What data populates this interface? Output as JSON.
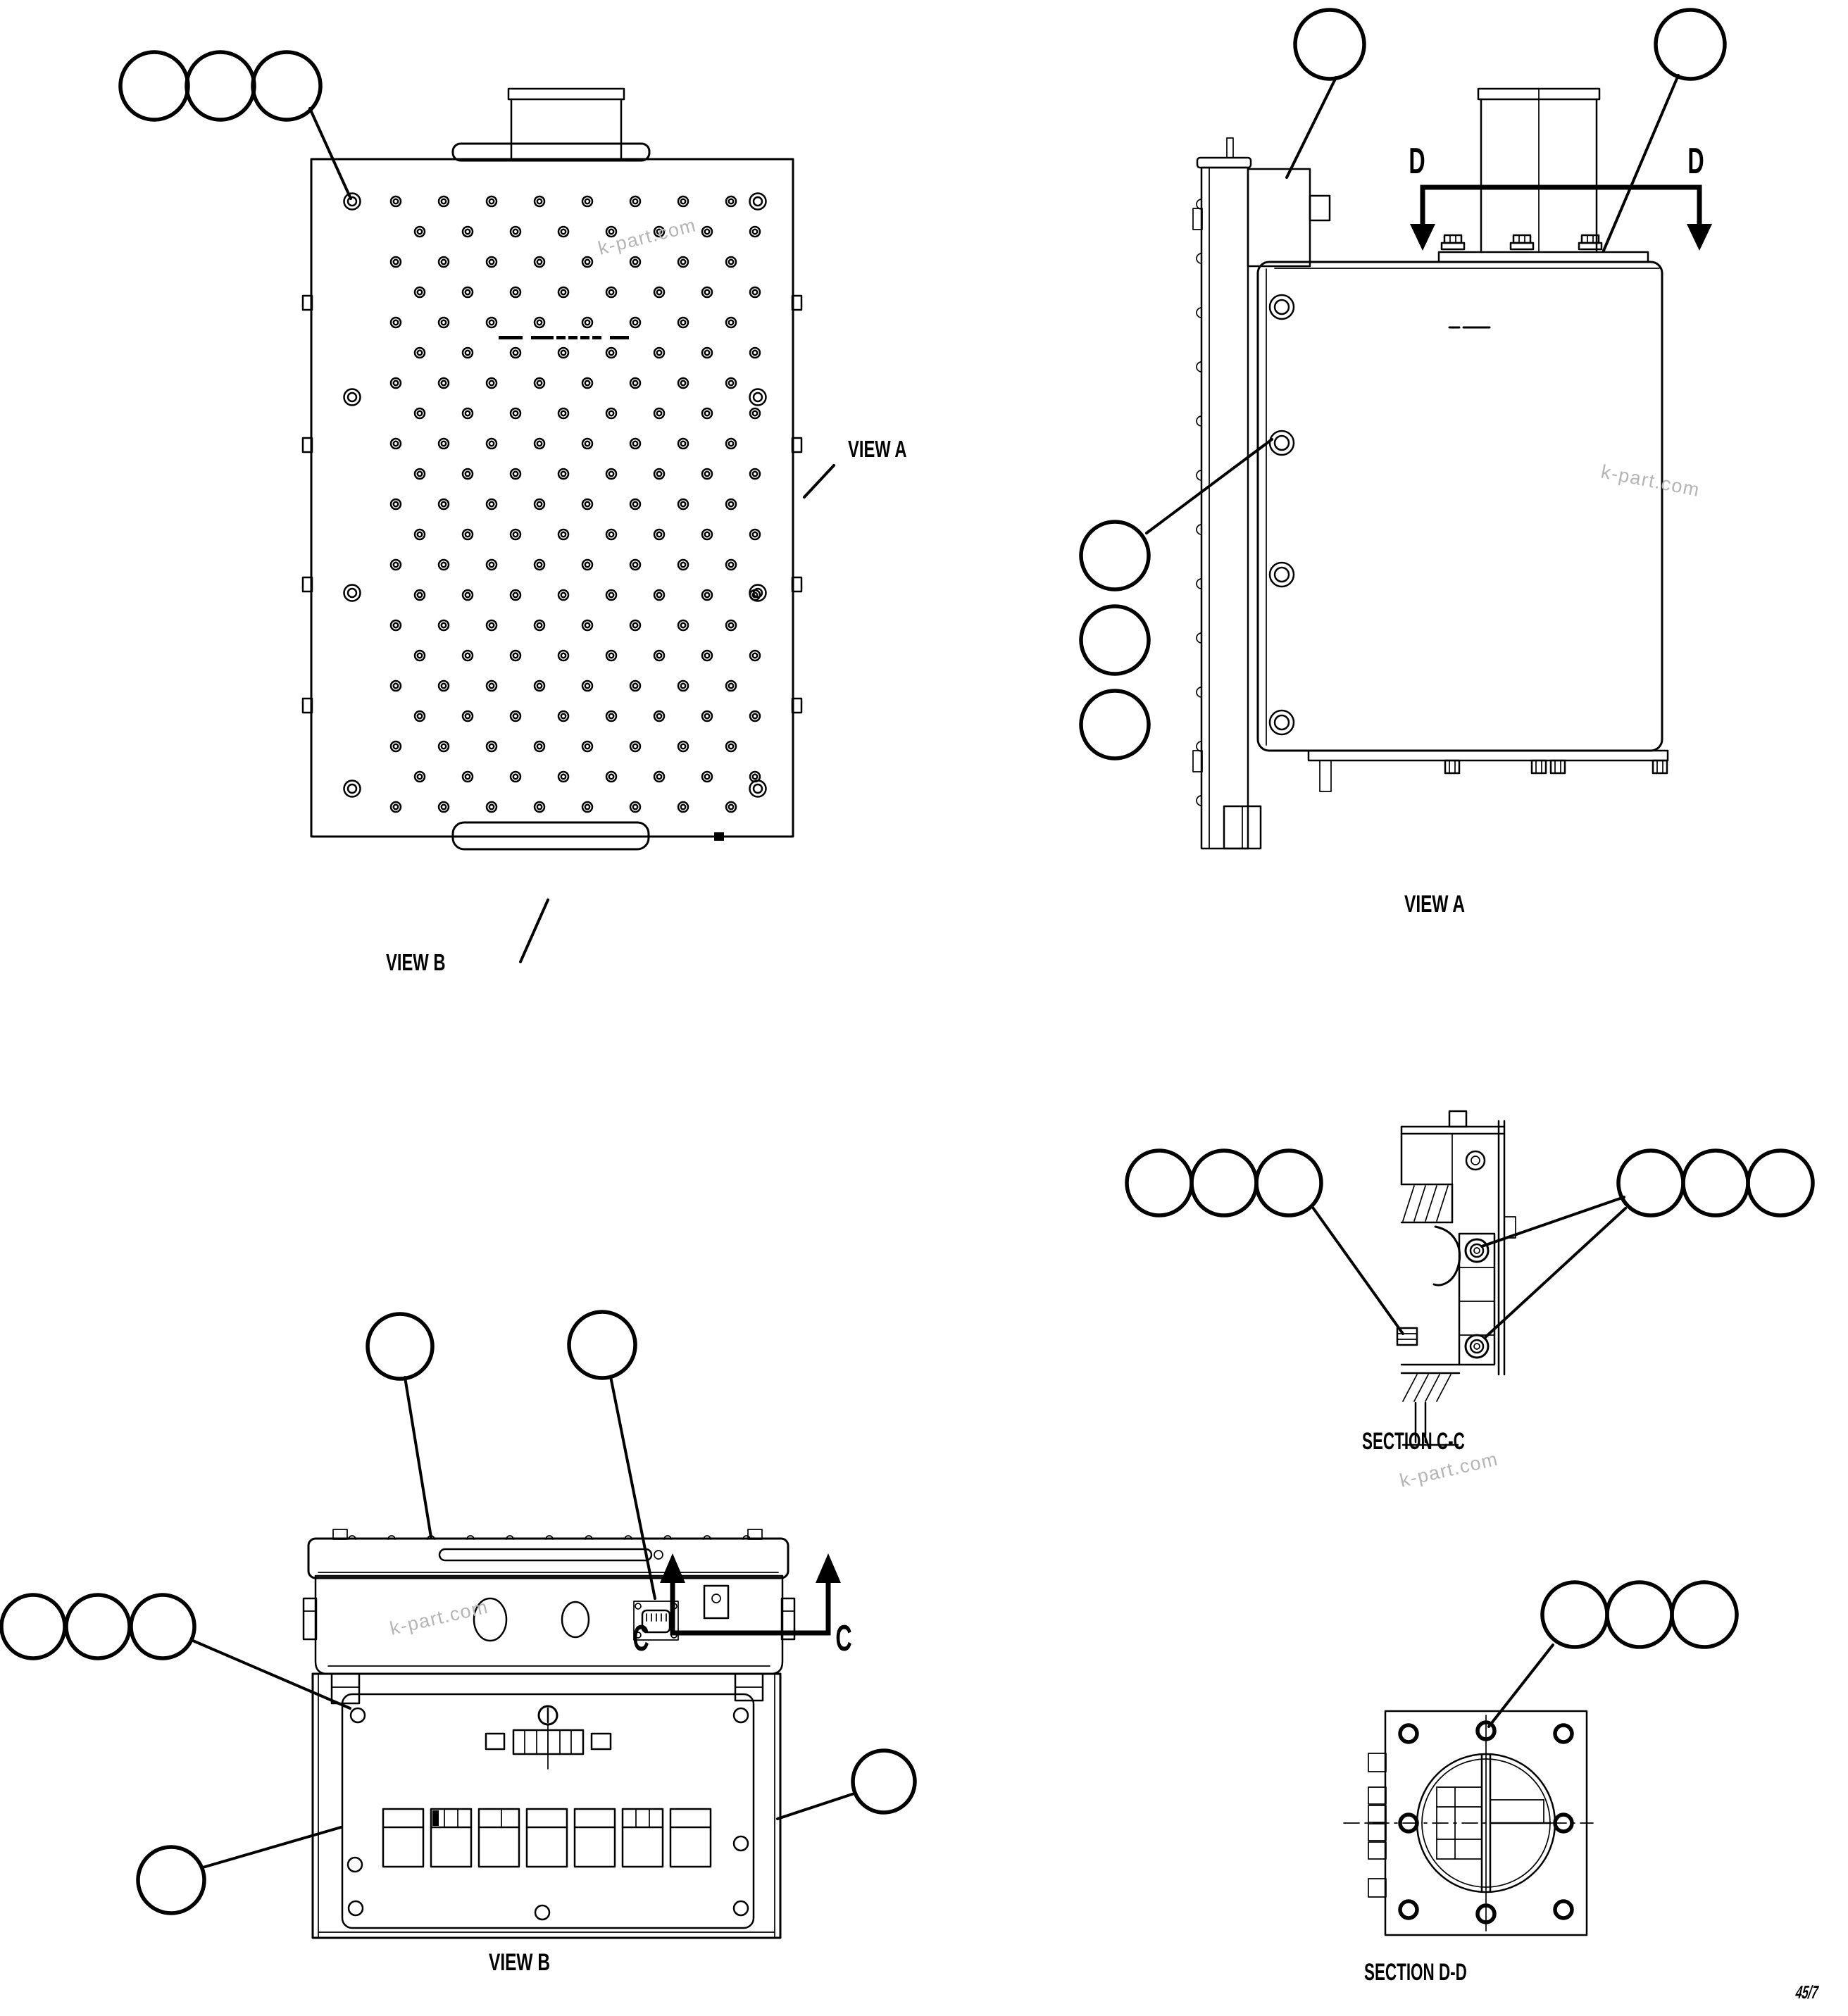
{
  "document": {
    "kind": "engineering-parts-diagram",
    "background_color": "#ffffff",
    "line_color": "#000000",
    "page_number": "45/7"
  },
  "watermark": {
    "text": "k-part.com",
    "color": "#b5b5b5",
    "count": 4
  },
  "labels": {
    "view_a_pointer": "VIEW A",
    "view_b_pointer": "VIEW B",
    "view_a_caption": "VIEW A",
    "view_b_caption": "VIEW B",
    "section_cc_caption": "SECTION C-C",
    "section_dd_caption": "SECTION D-D",
    "cut_line_c": "C",
    "cut_line_d": "D"
  },
  "callouts": {
    "balloon_text": "",
    "groups": [
      {
        "location": "plan-view-top-left",
        "count": 3
      },
      {
        "location": "side-view-top",
        "count": 2
      },
      {
        "location": "side-view-left",
        "count": 3
      },
      {
        "location": "view-b-top",
        "count": 2
      },
      {
        "location": "view-b-left",
        "count": 3
      },
      {
        "location": "view-b-bottom-left",
        "count": 1
      },
      {
        "location": "view-b-right",
        "count": 1
      },
      {
        "location": "section-cc-left",
        "count": 3
      },
      {
        "location": "section-cc-right",
        "count": 3
      },
      {
        "location": "section-dd-top",
        "count": 3
      }
    ]
  }
}
